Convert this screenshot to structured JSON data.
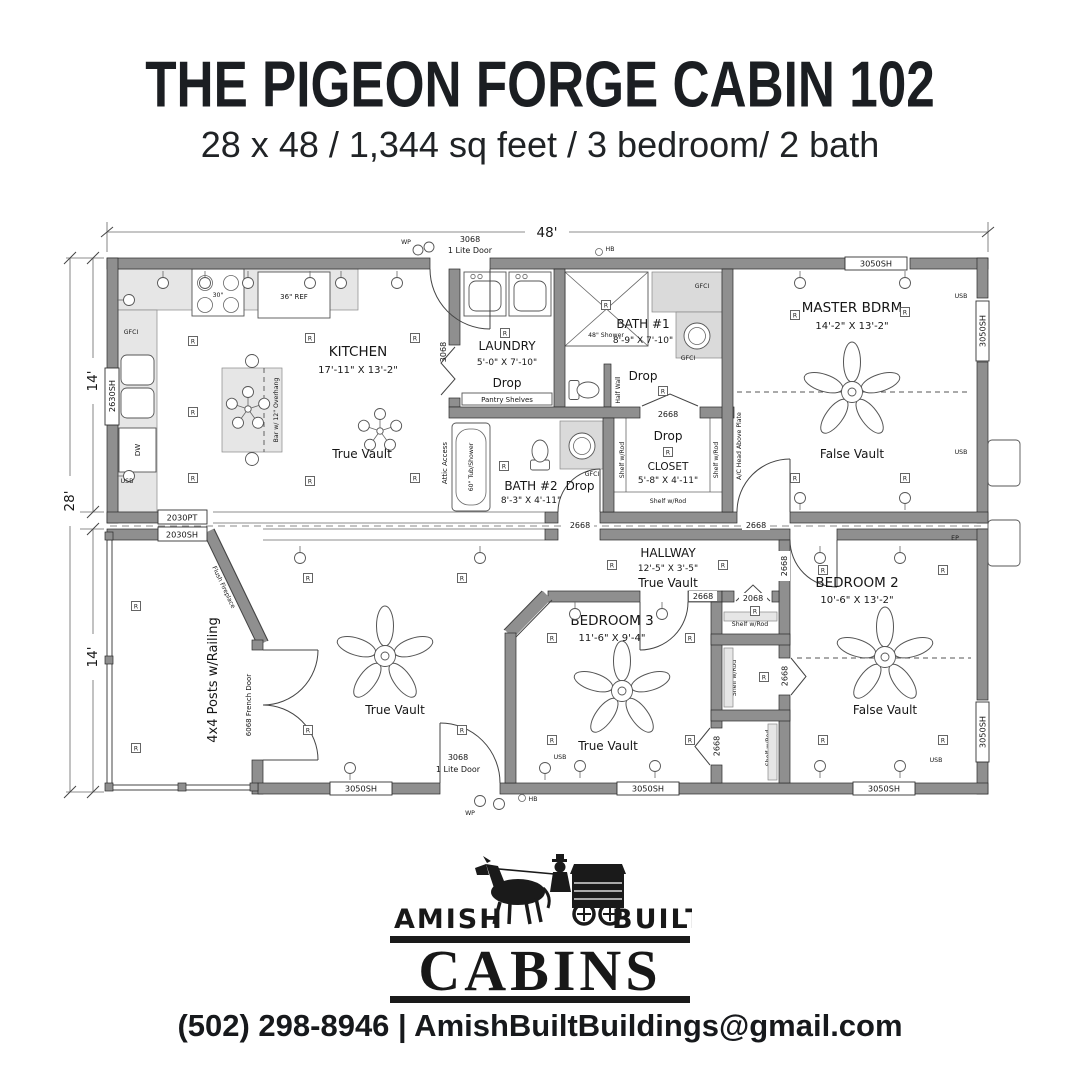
{
  "header": {
    "title": "THE PIGEON FORGE CABIN 102",
    "subtitle": "28 x 48 / 1,344 sq feet / 3 bedroom/ 2 bath"
  },
  "dims": {
    "overall_width": "48'",
    "overall_depth": "28'",
    "module_depth": "14'"
  },
  "rooms": {
    "kitchen": {
      "name": "KITCHEN",
      "size": "17'-11\" X 13'-2\"",
      "ceiling": "True Vault"
    },
    "laundry": {
      "name": "LAUNDRY",
      "size": "5'-0\" X 7'-10\"",
      "ceiling": "Drop"
    },
    "bath1": {
      "name": "BATH #1",
      "size": "8'-9\" X 7'-10\"",
      "ceiling": "Drop"
    },
    "bath2": {
      "name": "BATH #2",
      "size": "8'-3\" X 4'-11\"",
      "ceiling": "Drop"
    },
    "closet": {
      "name": "CLOSET",
      "size": "5'-8\" X 4'-11\"",
      "ceiling": "Drop"
    },
    "master": {
      "name": "MASTER BDRM",
      "size": "14'-2\" X 13'-2\"",
      "ceiling": "False Vault"
    },
    "hallway": {
      "name": "HALLWAY",
      "size": "12'-5\" X 3'-5\"",
      "ceiling": "True Vault"
    },
    "bedroom3": {
      "name": "BEDROOM 3",
      "size": "11'-6\" X 9'-4\"",
      "ceiling": "True Vault"
    },
    "bedroom2": {
      "name": "BEDROOM 2",
      "size": "10'-6\" X 13'-2\"",
      "ceiling": "False Vault"
    },
    "living": {
      "ceiling": "True Vault"
    },
    "porch": {
      "label": "4x4 Posts w/Railing"
    }
  },
  "fixtures": {
    "fridge": "36\" REF",
    "range": "30\"",
    "island": "Bar w/ 12\" Overhang",
    "pantry": "Pantry Shelves",
    "tub": "60\" Tub/Shower",
    "shower": "48\" Shower",
    "half_wall": "Half Wall",
    "attic": "Attic Access",
    "shelf_rod": "Shelf w/Rod",
    "ac_head": "A/C Head Above Plate",
    "fireplace": "Flush Fireplace",
    "dishwasher": "DW"
  },
  "openings": {
    "door_3068": "3068",
    "lite_door": "1 Lite Door",
    "door_2668": "2668",
    "door_2068": "2068",
    "french_door": "6068 French Door",
    "win_3050sh": "3050SH",
    "win_2630sh": "2630SH",
    "win_2030pt": "2030PT",
    "win_2030sh": "2030SH"
  },
  "symbols": {
    "receptacle": "R",
    "usb": "USB",
    "gfci": "GFCI",
    "wp": "WP",
    "hb": "HB",
    "ep": "EP"
  },
  "footer": {
    "brand_left": "AMISH",
    "brand_right": "BUILT",
    "brand_main": "CABINS",
    "contact": "(502) 298-8946 | AmishBuiltBuildings@gmail.com"
  }
}
